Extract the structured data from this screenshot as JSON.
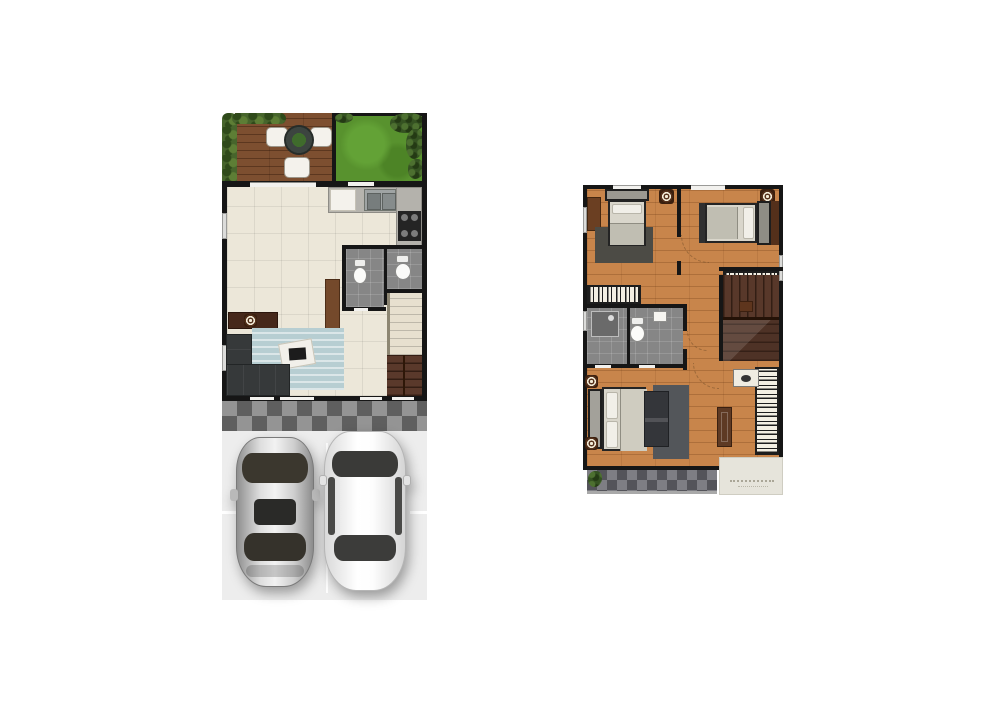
{
  "page": {
    "background": "#ffffff",
    "type": "architectural-floor-plan",
    "plans_count": 2
  },
  "visible_text": [],
  "floor_plans": {
    "left_plan": {
      "name": "ground-floor",
      "areas": [
        "terrace-deck",
        "garden",
        "dining-area",
        "kitchen",
        "bathroom",
        "living-room",
        "staircase",
        "porch-walkway",
        "driveway"
      ],
      "furniture": [
        "round-patio-table",
        "patio-chair",
        "patio-chair",
        "patio-chair",
        "dining-table",
        "dining-chair",
        "dining-chair",
        "dining-chair",
        "dining-chair",
        "kitchen-island",
        "kitchen-sink",
        "stove",
        "kitchen-counter",
        "toilet",
        "toilet",
        "sideboard",
        "l-shaped-sofa",
        "area-rug",
        "coffee-table",
        "laptop",
        "silver-car",
        "white-car"
      ]
    },
    "right_plan": {
      "name": "upper-floor",
      "areas": [
        "bedroom-1",
        "bedroom-2",
        "master-bedroom",
        "bathroom",
        "hallway",
        "staircase",
        "balcony",
        "roof-ledge"
      ],
      "furniture": [
        "single-bed",
        "double-bed",
        "master-bed",
        "desk",
        "wardrobe",
        "wardrobe",
        "wardrobe",
        "shower",
        "toilet",
        "wash-basin",
        "bedroom-bench",
        "door-panel",
        "cabinet",
        "potted-plant",
        "wall-decor-ring",
        "wall-decor-ring",
        "wall-decor-ring",
        "wall-decor-ring"
      ]
    }
  },
  "palette": {
    "background": "#ffffff",
    "walls": "#161616",
    "tile_floor": "#ece7d9",
    "wood_floor": "#c8854b",
    "deck_wood": "#7d4f30",
    "grass": "#58922e",
    "hedge": "#47652c",
    "bathroom_tile": "#868686",
    "porch_checker_dark": "#5f5f5f",
    "porch_checker_light": "#949494",
    "balcony_checker_dark": "#54545a",
    "balcony_checker_light": "#7e7e84",
    "driveway": "#ededed",
    "sofa": "#36393a",
    "rug_blue": "#b7ced2",
    "rug_dark": "#4c4b45",
    "stairs_dark": "#5a392b",
    "stairs_light": "#e7e0cf",
    "mattress": "#d9d6cb",
    "wardrobe_stripe": "#1d1d1d",
    "car_silver": "#c9c9c9",
    "car_white": "#f7f7f7",
    "concrete_ledge": "#e6e4db"
  }
}
